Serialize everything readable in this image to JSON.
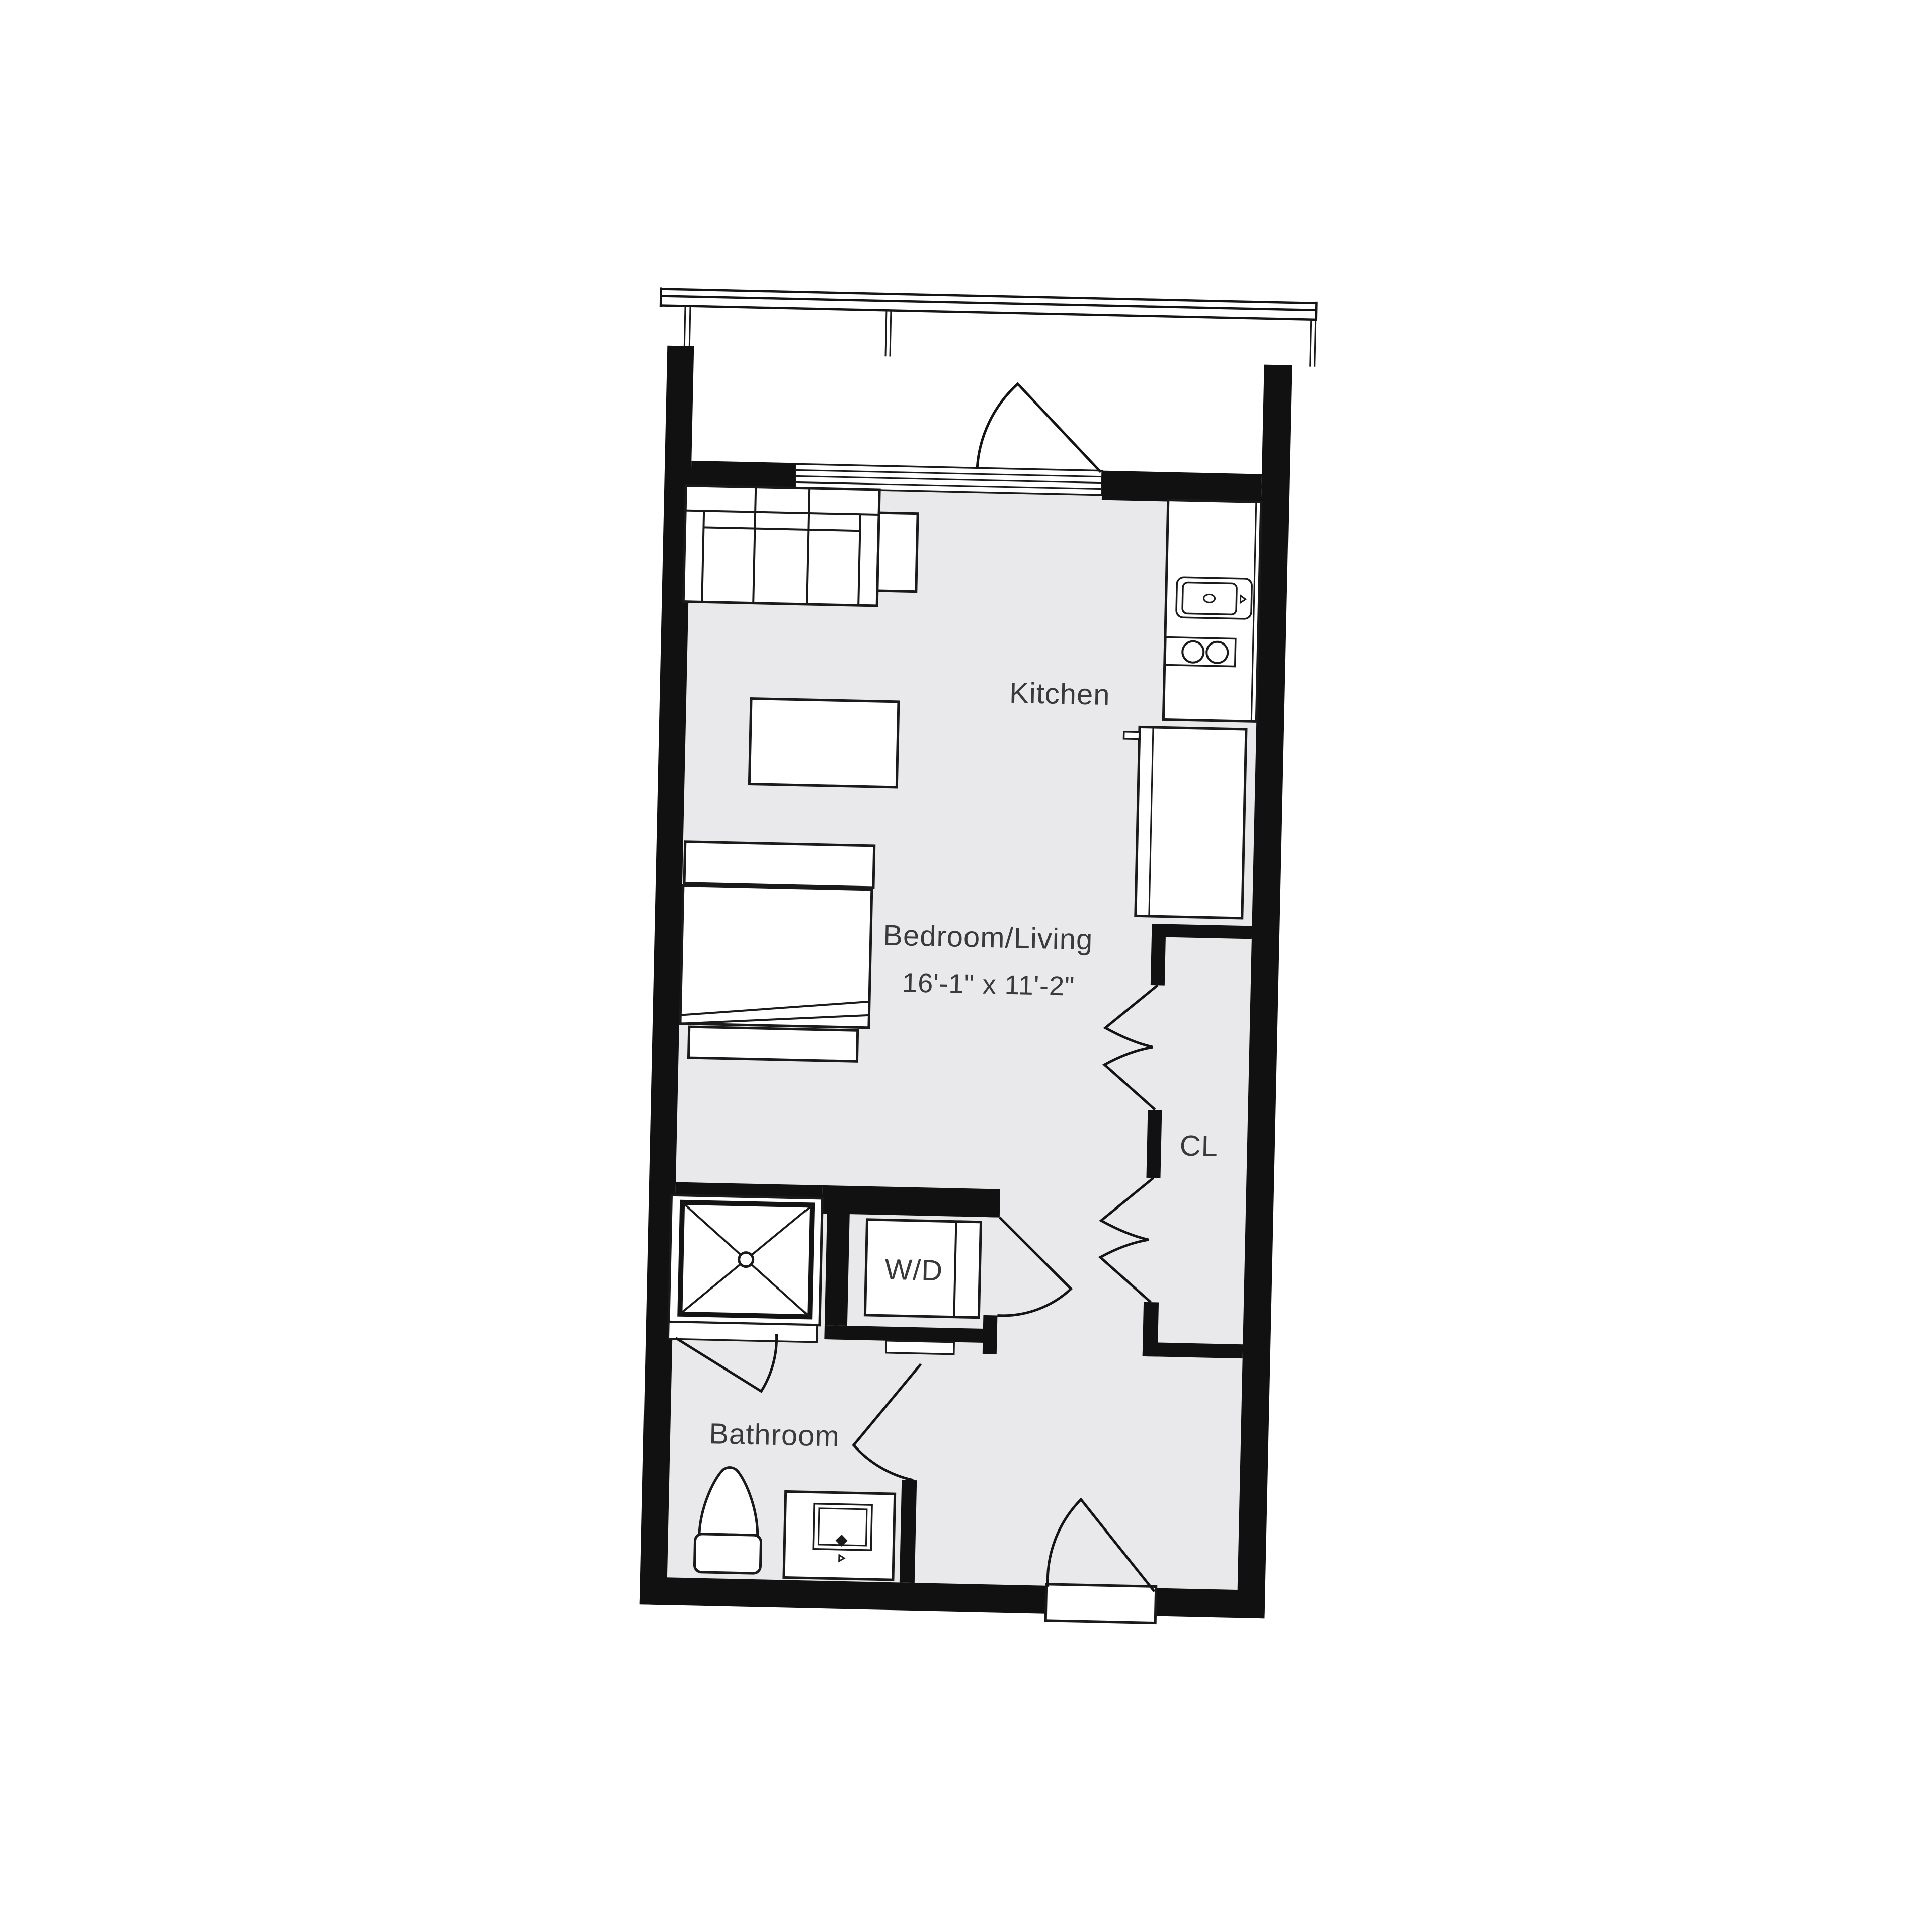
{
  "floorplan": {
    "type": "studio-apartment-floor-plan",
    "rooms": {
      "kitchen": {
        "label": "Kitchen"
      },
      "bedroom_living": {
        "label": "Bedroom/Living",
        "dimensions": "16'-1\" x 11'-2\""
      },
      "closet": {
        "label": "CL"
      },
      "washer_dryer": {
        "label": "W/D"
      },
      "bathroom": {
        "label": "Bathroom"
      }
    },
    "fixtures": [
      "balcony-railing",
      "balcony-door-swing",
      "sliding-window-band",
      "sofa",
      "side-table",
      "coffee-table",
      "bed",
      "bed-headboard",
      "bed-bench",
      "kitchen-counter",
      "kitchen-sink",
      "cooktop-two-burners",
      "refrigerator",
      "shower-stall",
      "washer-dryer-unit",
      "closet-bifold-doors",
      "toilet",
      "bathroom-vanity-sink",
      "interior-door-swings",
      "entry-door"
    ],
    "colors": {
      "wall": "#111111",
      "floor": "#e9e9eb",
      "outline": "#1a1a1a",
      "text": "#3a3a3a",
      "background": "#ffffff"
    }
  }
}
